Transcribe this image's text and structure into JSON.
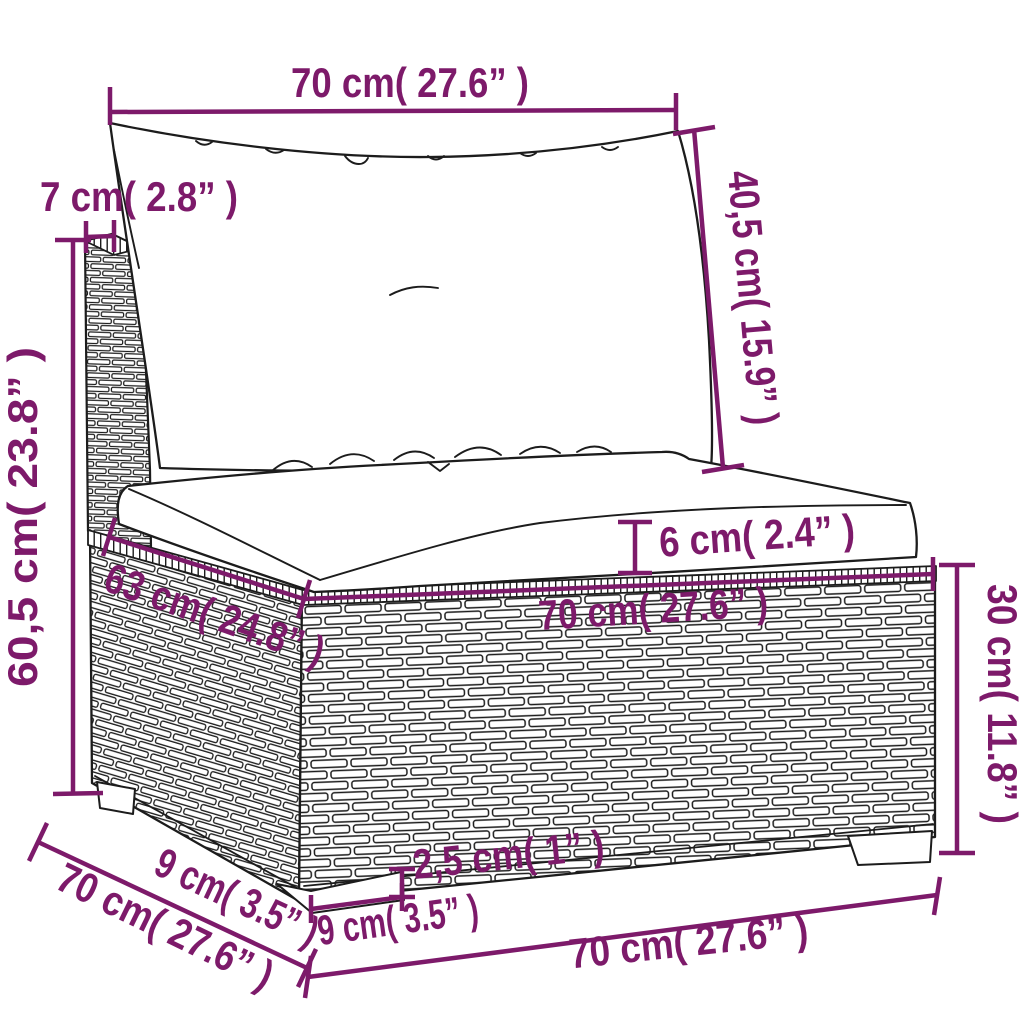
{
  "colors": {
    "annotation": "#7d1a6a",
    "line_art": "#1c1c1c",
    "background": "#ffffff"
  },
  "diagram": {
    "dimensions": {
      "back_width": "70 cm( 27.6” )",
      "back_cushion_height": "40,5 cm( 15.9” )",
      "frame_thickness": "7 cm( 2.8” )",
      "total_height": "60,5 cm( 23.8” )",
      "seat_depth": "63 cm( 24.8” )",
      "seat_width": "70 cm( 27.6” )",
      "cushion_thickness": "6 cm( 2.4” )",
      "base_height": "30 cm( 11.8” )",
      "leg_height": "2,5 cm( 1” )",
      "leg_width": "9 cm( 3.5” )",
      "leg_depth": "9 cm( 3.5” )",
      "base_depth": "70 cm( 27.6” )",
      "base_width": "70 cm( 27.6” )"
    }
  }
}
